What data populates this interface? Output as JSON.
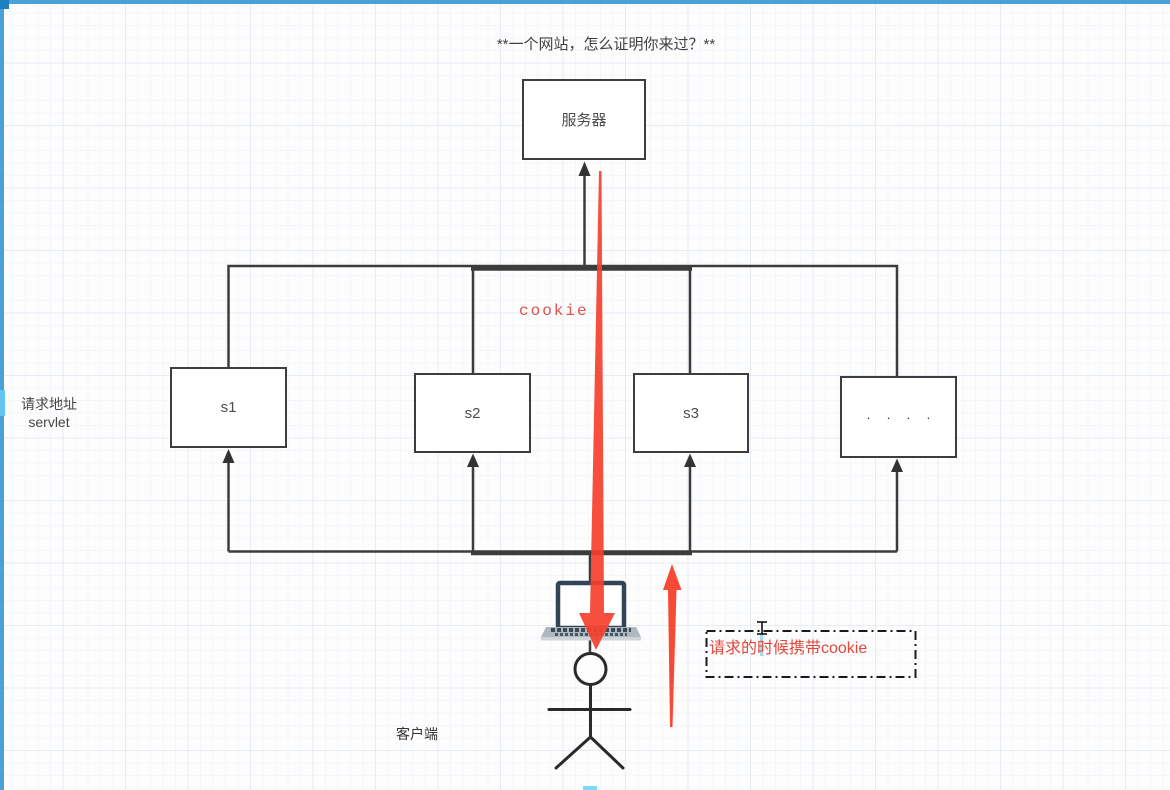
{
  "page": {
    "title": "**一个网站，怎么证明你来过？**"
  },
  "colors": {
    "accent_blue": "#4aa1da",
    "connector": "#3c3c3c",
    "red_arrow": "#f5402c",
    "red_text": "#e2473a",
    "caret_blue": "#a6dcec"
  },
  "nodes": {
    "server": {
      "label": "服务器"
    },
    "s1": {
      "label": "s1"
    },
    "s2": {
      "label": "s2"
    },
    "s3": {
      "label": "s3"
    },
    "more": {
      "label": "· · · ·"
    }
  },
  "labels": {
    "request_address_line1": "请求地址",
    "request_address_line2": "servlet",
    "cookie": "cookie",
    "client": "客户端",
    "note": "请求的时候携带cookie"
  },
  "icons": {
    "laptop": "laptop-icon",
    "person": "stick-figure-icon"
  }
}
